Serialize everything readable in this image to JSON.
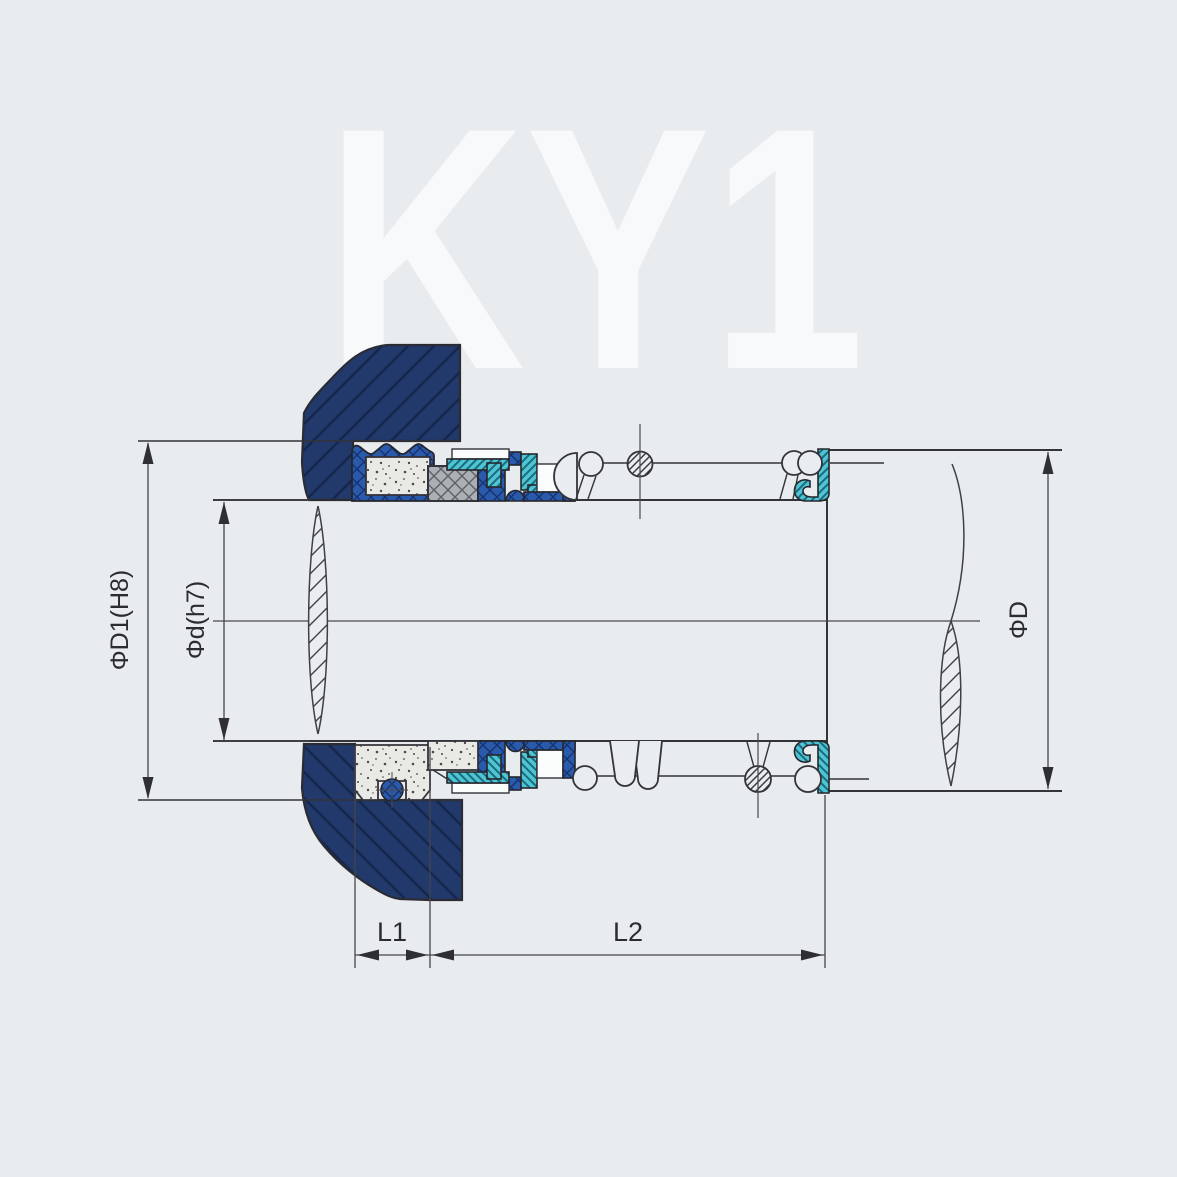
{
  "watermark": "KY1",
  "labels": {
    "bore_diameter": "ΦD1(H8)",
    "shaft_diameter": "Φd(h7)",
    "outer_diameter": "ΦD",
    "length_1": "L1",
    "length_2": "L2"
  },
  "colors": {
    "background": "#e8ecef",
    "watermark": "#f7f9fb",
    "gland_navy": "#22396b",
    "gland_hatch": "#15264d",
    "elastomer_blue": "#2a5aab",
    "elastomer_blue_hatch": "#16336e",
    "rubber_teal": "#4ec5d4",
    "rubber_teal_hatch": "#1d6b7a",
    "seal_face_gray": "#abb0b4",
    "seat_speckled": "#e9e9e5",
    "outline": "#33333a",
    "dimension_line": "#45454b"
  }
}
